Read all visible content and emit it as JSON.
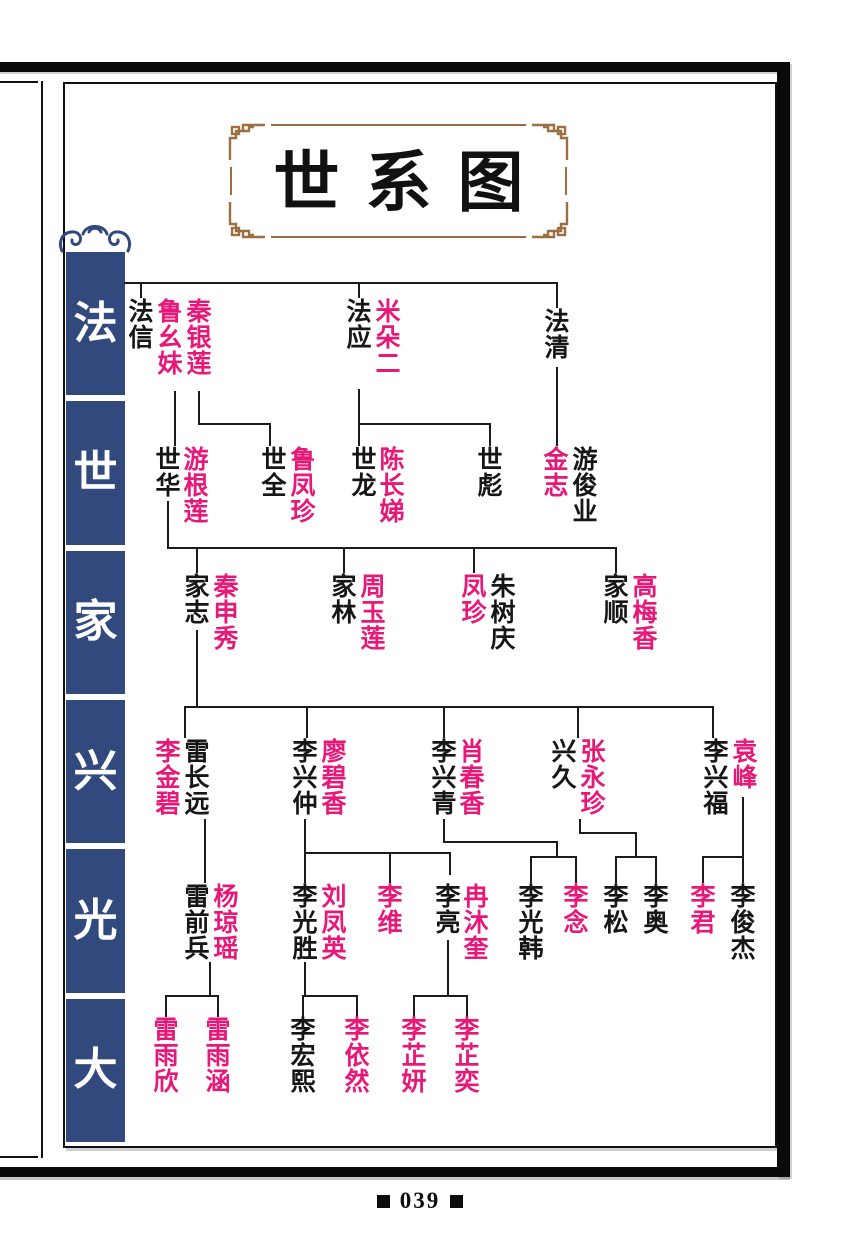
{
  "page": {
    "title": "世系图",
    "number": "039"
  },
  "colors": {
    "accent": "#e81879",
    "sidebar": "#31497c",
    "frame_ornament": "#9c6f42",
    "ink": "#161616"
  },
  "sidebar": {
    "labels": [
      "法",
      "世",
      "家",
      "兴",
      "光",
      "大"
    ]
  },
  "tree": {
    "legend": {
      "black": "descendant",
      "pink": "spouse-or-female"
    },
    "persons": [
      {
        "n": "法信",
        "c": "black",
        "x": 141,
        "y": 300
      },
      {
        "n": "鲁幺妹",
        "c": "pink",
        "x": 170,
        "y": 300
      },
      {
        "n": "秦银莲",
        "c": "pink",
        "x": 199,
        "y": 300
      },
      {
        "n": "法应",
        "c": "black",
        "x": 359,
        "y": 300
      },
      {
        "n": "米朵二",
        "c": "pink",
        "x": 388,
        "y": 300
      },
      {
        "n": "法清",
        "c": "black",
        "x": 557,
        "y": 310
      },
      {
        "n": "世华",
        "c": "black",
        "x": 168,
        "y": 448
      },
      {
        "n": "游根莲",
        "c": "pink",
        "x": 196,
        "y": 448
      },
      {
        "n": "世全",
        "c": "black",
        "x": 274,
        "y": 448
      },
      {
        "n": "鲁凤珍",
        "c": "pink",
        "x": 303,
        "y": 448
      },
      {
        "n": "世龙",
        "c": "black",
        "x": 364,
        "y": 448
      },
      {
        "n": "陈长娣",
        "c": "pink",
        "x": 392,
        "y": 448
      },
      {
        "n": "世彪",
        "c": "black",
        "x": 490,
        "y": 448
      },
      {
        "n": "金志",
        "c": "pink",
        "x": 556,
        "y": 448
      },
      {
        "n": "游俊业",
        "c": "black",
        "x": 585,
        "y": 448
      },
      {
        "n": "家志",
        "c": "black",
        "x": 197,
        "y": 575
      },
      {
        "n": "秦申秀",
        "c": "pink",
        "x": 226,
        "y": 575
      },
      {
        "n": "家林",
        "c": "black",
        "x": 344,
        "y": 575
      },
      {
        "n": "周玉莲",
        "c": "pink",
        "x": 373,
        "y": 575
      },
      {
        "n": "凤珍",
        "c": "pink",
        "x": 474,
        "y": 575
      },
      {
        "n": "朱树庆",
        "c": "black",
        "x": 503,
        "y": 575
      },
      {
        "n": "家顺",
        "c": "black",
        "x": 616,
        "y": 575
      },
      {
        "n": "高梅香",
        "c": "pink",
        "x": 645,
        "y": 575
      },
      {
        "n": "李金碧",
        "c": "pink",
        "x": 168,
        "y": 740
      },
      {
        "n": "雷长远",
        "c": "black",
        "x": 197,
        "y": 740
      },
      {
        "n": "李兴仲",
        "c": "black",
        "x": 305,
        "y": 740
      },
      {
        "n": "廖碧香",
        "c": "pink",
        "x": 334,
        "y": 740
      },
      {
        "n": "李兴青",
        "c": "black",
        "x": 444,
        "y": 740
      },
      {
        "n": "肖春香",
        "c": "pink",
        "x": 472,
        "y": 740
      },
      {
        "n": "兴久",
        "c": "black",
        "x": 564,
        "y": 740
      },
      {
        "n": "张永珍",
        "c": "pink",
        "x": 593,
        "y": 740
      },
      {
        "n": "李兴福",
        "c": "black",
        "x": 716,
        "y": 740
      },
      {
        "n": "袁峰",
        "c": "pink",
        "x": 745,
        "y": 740
      },
      {
        "n": "雷前兵",
        "c": "black",
        "x": 197,
        "y": 885
      },
      {
        "n": "杨琼瑶",
        "c": "pink",
        "x": 226,
        "y": 885
      },
      {
        "n": "李光胜",
        "c": "black",
        "x": 305,
        "y": 885
      },
      {
        "n": "刘凤英",
        "c": "pink",
        "x": 334,
        "y": 885
      },
      {
        "n": "李维",
        "c": "pink",
        "x": 390,
        "y": 885
      },
      {
        "n": "李亮",
        "c": "black",
        "x": 448,
        "y": 885
      },
      {
        "n": "冉沐奎",
        "c": "pink",
        "x": 476,
        "y": 885
      },
      {
        "n": "李光韩",
        "c": "black",
        "x": 531,
        "y": 885
      },
      {
        "n": "李念",
        "c": "pink",
        "x": 576,
        "y": 885
      },
      {
        "n": "李松",
        "c": "black",
        "x": 616,
        "y": 885
      },
      {
        "n": "李奥",
        "c": "black",
        "x": 656,
        "y": 885
      },
      {
        "n": "李君",
        "c": "pink",
        "x": 703,
        "y": 885
      },
      {
        "n": "李俊杰",
        "c": "black",
        "x": 743,
        "y": 885
      },
      {
        "n": "雷雨欣",
        "c": "pink",
        "x": 166,
        "y": 1018
      },
      {
        "n": "雷雨涵",
        "c": "pink",
        "x": 218,
        "y": 1018
      },
      {
        "n": "李宏熙",
        "c": "black",
        "x": 303,
        "y": 1018
      },
      {
        "n": "李依然",
        "c": "pink",
        "x": 357,
        "y": 1018
      },
      {
        "n": "李芷妍",
        "c": "pink",
        "x": 414,
        "y": 1018
      },
      {
        "n": "李芷奕",
        "c": "pink",
        "x": 467,
        "y": 1018
      }
    ],
    "lines": [
      [
        125,
        283,
        557,
        283
      ],
      [
        141,
        283,
        141,
        297
      ],
      [
        359,
        283,
        359,
        297
      ],
      [
        557,
        283,
        557,
        307
      ],
      [
        175,
        392,
        175,
        445
      ],
      [
        199,
        392,
        199,
        424
      ],
      [
        199,
        424,
        270,
        424
      ],
      [
        270,
        424,
        270,
        445
      ],
      [
        359,
        390,
        359,
        445
      ],
      [
        359,
        424,
        490,
        424
      ],
      [
        490,
        424,
        490,
        445
      ],
      [
        557,
        368,
        557,
        445
      ],
      [
        168,
        502,
        168,
        548
      ],
      [
        168,
        548,
        616,
        548
      ],
      [
        197,
        548,
        197,
        572
      ],
      [
        344,
        548,
        344,
        572
      ],
      [
        474,
        548,
        474,
        572
      ],
      [
        616,
        548,
        616,
        572
      ],
      [
        197,
        631,
        197,
        707
      ],
      [
        185,
        707,
        713,
        707
      ],
      [
        185,
        707,
        185,
        737
      ],
      [
        307,
        707,
        307,
        737
      ],
      [
        444,
        707,
        444,
        737
      ],
      [
        578,
        707,
        578,
        737
      ],
      [
        713,
        707,
        713,
        737
      ],
      [
        205,
        820,
        205,
        882
      ],
      [
        305,
        820,
        305,
        882
      ],
      [
        305,
        853,
        450,
        853
      ],
      [
        390,
        853,
        390,
        882
      ],
      [
        450,
        853,
        450,
        874
      ],
      [
        444,
        820,
        444,
        842
      ],
      [
        444,
        842,
        557,
        842
      ],
      [
        557,
        842,
        557,
        857
      ],
      [
        531,
        857,
        576,
        857
      ],
      [
        531,
        857,
        531,
        882
      ],
      [
        576,
        857,
        576,
        882
      ],
      [
        580,
        820,
        580,
        833
      ],
      [
        580,
        833,
        636,
        833
      ],
      [
        636,
        833,
        636,
        857
      ],
      [
        616,
        857,
        656,
        857
      ],
      [
        616,
        857,
        616,
        882
      ],
      [
        656,
        857,
        656,
        882
      ],
      [
        743,
        798,
        743,
        882
      ],
      [
        703,
        857,
        743,
        857
      ],
      [
        703,
        857,
        703,
        882
      ],
      [
        210,
        963,
        210,
        996
      ],
      [
        166,
        996,
        218,
        996
      ],
      [
        166,
        996,
        166,
        1016
      ],
      [
        218,
        996,
        218,
        1016
      ],
      [
        305,
        963,
        305,
        996
      ],
      [
        303,
        996,
        357,
        996
      ],
      [
        303,
        996,
        303,
        1016
      ],
      [
        357,
        996,
        357,
        1016
      ],
      [
        448,
        941,
        448,
        996
      ],
      [
        414,
        996,
        467,
        996
      ],
      [
        414,
        996,
        414,
        1016
      ],
      [
        467,
        996,
        467,
        1016
      ]
    ]
  }
}
